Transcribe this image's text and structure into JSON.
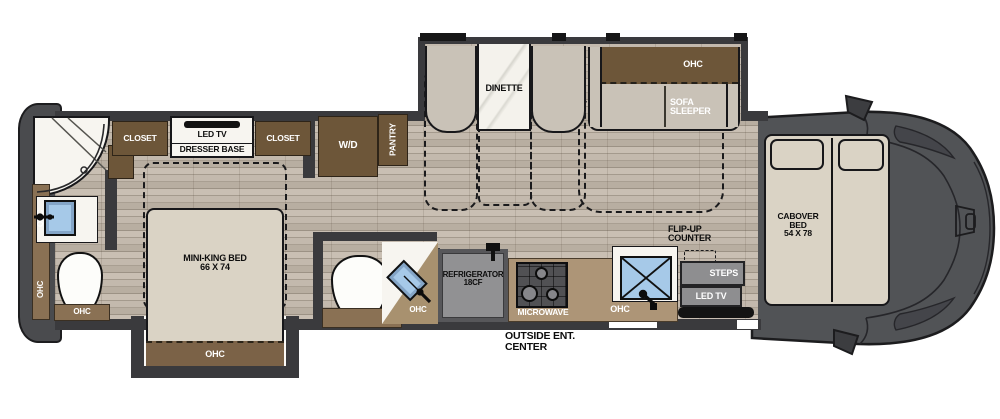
{
  "title": "Class C motorhome floor plan",
  "colors": {
    "wall": "#3a3a3d",
    "cabinet_brown": "#6d5639",
    "counter_tan": "#ad9577",
    "bath_brown": "#8a7154",
    "floor_wood": "#b2a89c",
    "sink_blue": "#a6c9e8",
    "cab_grey": "#515356",
    "furniture_grey": "#c9c2b7",
    "mattress_beige": "#dad3c5"
  },
  "labels": {
    "closet_left": "CLOSET",
    "closet_right": "CLOSET",
    "bedroom_tv": "LED TV",
    "dresser_base": "DRESSER BASE",
    "washer_dryer": "W/D",
    "pantry": "PANTRY",
    "dinette": "DINETTE",
    "sofa_ohc": "OHC",
    "sofa_line1": "SOFA",
    "sofa_line2": "SLEEPER",
    "bed_name": "MINI-KING BED",
    "bed_size": "66 X 74",
    "bed_slide_ohc": "OHC",
    "bath_wall_ohc_upper": "OHC",
    "bath_wall_ohc_lower": "OHC",
    "bath_toilet_ohc": "OHC",
    "half_bath_ohc": "OHC",
    "refrigerator_line1": "REFRIGERATOR",
    "refrigerator_line2": "18CF",
    "microwave": "MICROWAVE",
    "kitchen_ohc": "OHC",
    "outside_line1": "OUTSIDE ENT.",
    "outside_line2": "CENTER",
    "flip_line1": "FLIP-UP",
    "flip_line2": "COUNTER",
    "steps": "STEPS",
    "entry_tv": "LED TV",
    "cab_line1": "CABOVER",
    "cab_line2": "BED",
    "cab_size": "54 X 78"
  }
}
